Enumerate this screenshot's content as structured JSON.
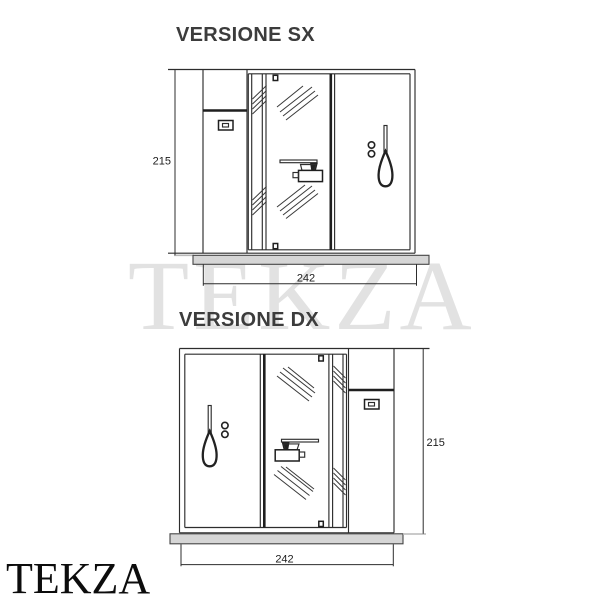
{
  "watermark": {
    "text": "TEKZA"
  },
  "logo": {
    "text": "TEKZA"
  },
  "drawings": {
    "sx": {
      "title": "VERSIONE SX",
      "height_cm": "215",
      "width_cm": "242"
    },
    "dx": {
      "title": "VERSIONE DX",
      "height_cm": "215",
      "width_cm": "242"
    }
  },
  "colors": {
    "line": "#2d2d2d",
    "tray_fill": "#d6d6d6",
    "watermark": "#e2e2e2",
    "title": "#3c3c3c"
  }
}
